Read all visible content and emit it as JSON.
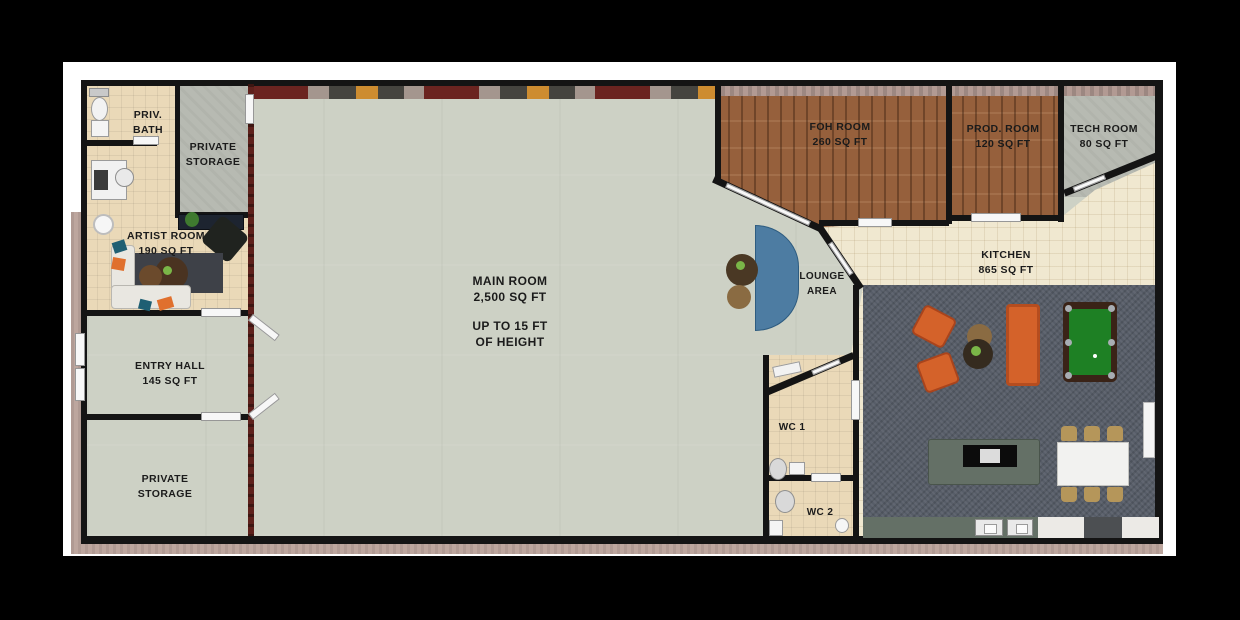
{
  "plan_title": "studio floor plan",
  "rooms": {
    "priv_bath": {
      "line1": "PRIV.",
      "line2": "BATH"
    },
    "private_storage_top": {
      "line1": "PRIVATE",
      "line2": "STORAGE"
    },
    "artist_room": {
      "line1": "ARTIST ROOM",
      "line2": "190 SQ FT"
    },
    "entry_hall": {
      "line1": "ENTRY HALL",
      "line2": "145 SQ FT"
    },
    "private_storage_bottom": {
      "line1": "PRIVATE",
      "line2": "STORAGE"
    },
    "main_room": {
      "line1": "MAIN ROOM",
      "line2": "2,500 SQ FT",
      "line3": "UP TO 15 FT",
      "line4": "OF HEIGHT"
    },
    "foh_room": {
      "line1": "FOH ROOM",
      "line2": "260 SQ FT"
    },
    "prod_room": {
      "line1": "PROD. ROOM",
      "line2": "120 SQ FT"
    },
    "tech_room": {
      "line1": "TECH ROOM",
      "line2": "80 SQ FT"
    },
    "kitchen": {
      "line1": "KITCHEN",
      "line2": "865 SQ FT"
    },
    "lounge": {
      "line1": "LOUNGE",
      "line2": "AREA"
    },
    "wc1": {
      "label": "WC 1"
    },
    "wc2": {
      "label": "WC 2"
    }
  },
  "colors": {
    "wall": "#141414",
    "brick": "#5e211c",
    "exterior": "#bda69e",
    "floor_main": "#cdd1c5",
    "floor_tile": "#ead9b8",
    "floor_gray": "#b7bab2",
    "wood": "#96603c",
    "kitchen_tile": "#f0e8d0",
    "carpet": "#575d68",
    "sofa_blue": "#4d7ca2",
    "accent_orange": "#d4622a",
    "pool_green": "#1e8024",
    "island": "#647066",
    "chair_tan": "#b5965a"
  }
}
